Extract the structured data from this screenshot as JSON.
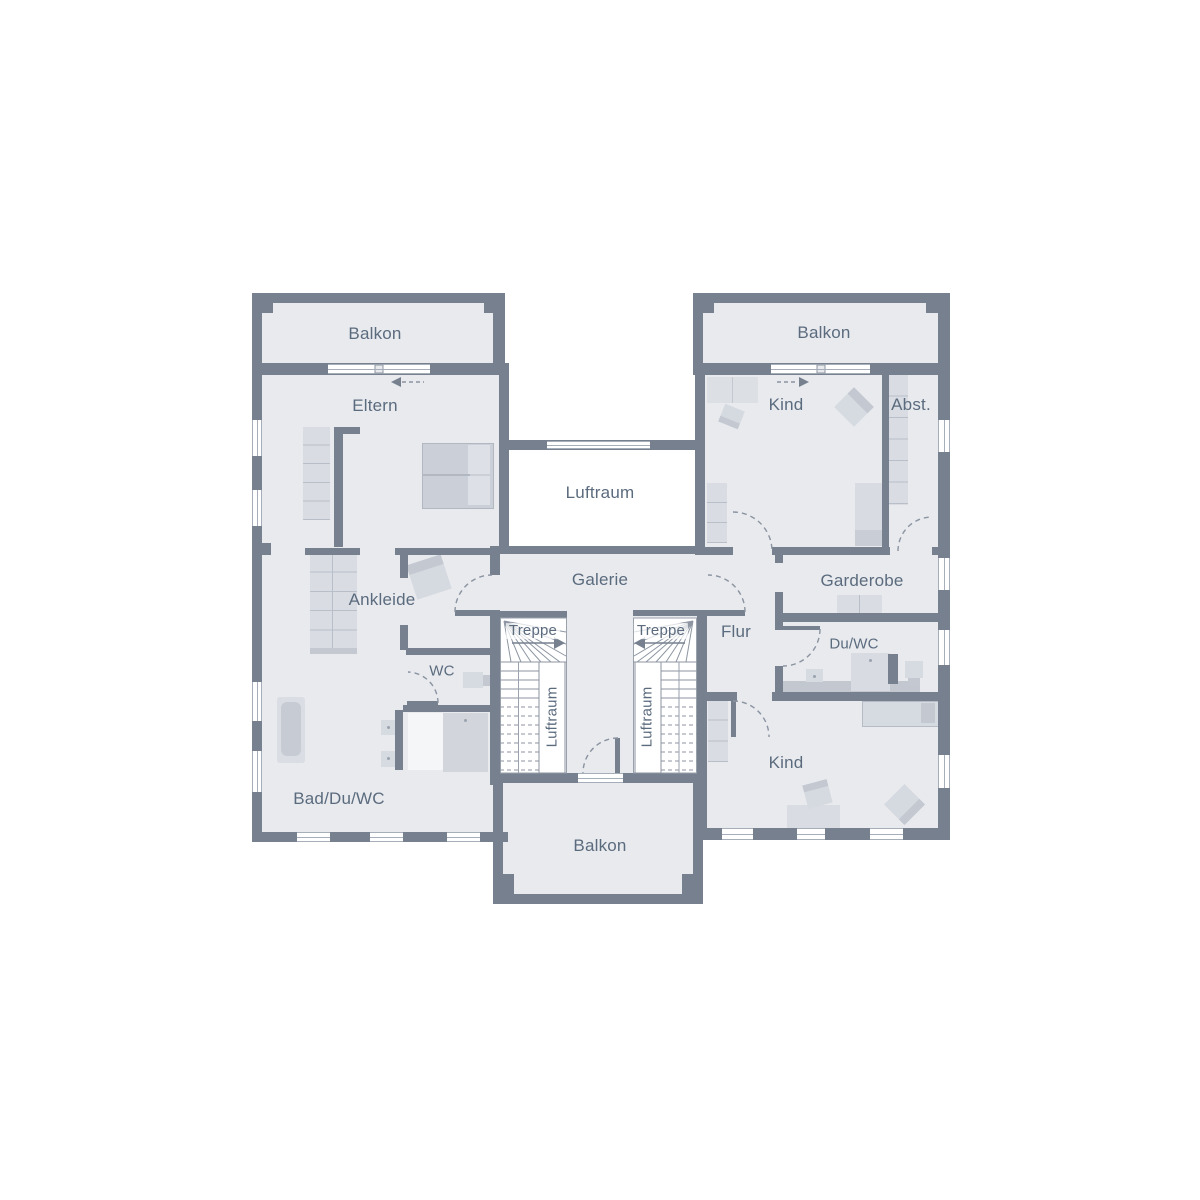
{
  "rooms": {
    "balkon_top_left": "Balkon",
    "balkon_top_right": "Balkon",
    "eltern": "Eltern",
    "kind_top": "Kind",
    "abst": "Abst.",
    "luftraum_center": "Luftraum",
    "galerie": "Galerie",
    "ankleide": "Ankleide",
    "garderobe": "Garderobe",
    "treppe_left": "Treppe",
    "treppe_right": "Treppe",
    "flur": "Flur",
    "wc": "WC",
    "du_wc": "Du/WC",
    "luftraum_stair_left": "Luftraum",
    "luftraum_stair_right": "Luftraum",
    "bad_du_wc": "Bad/Du/WC",
    "kind_bottom": "Kind",
    "balkon_bottom": "Balkon"
  },
  "colors": {
    "wall": "#76808f",
    "floor": "#e8eaee",
    "void": "#ffffff",
    "furniture": "#d8dbe2",
    "furniture_dark": "#c3c8d1",
    "outline": "#8d96a2",
    "text": "#5b6b7e"
  }
}
